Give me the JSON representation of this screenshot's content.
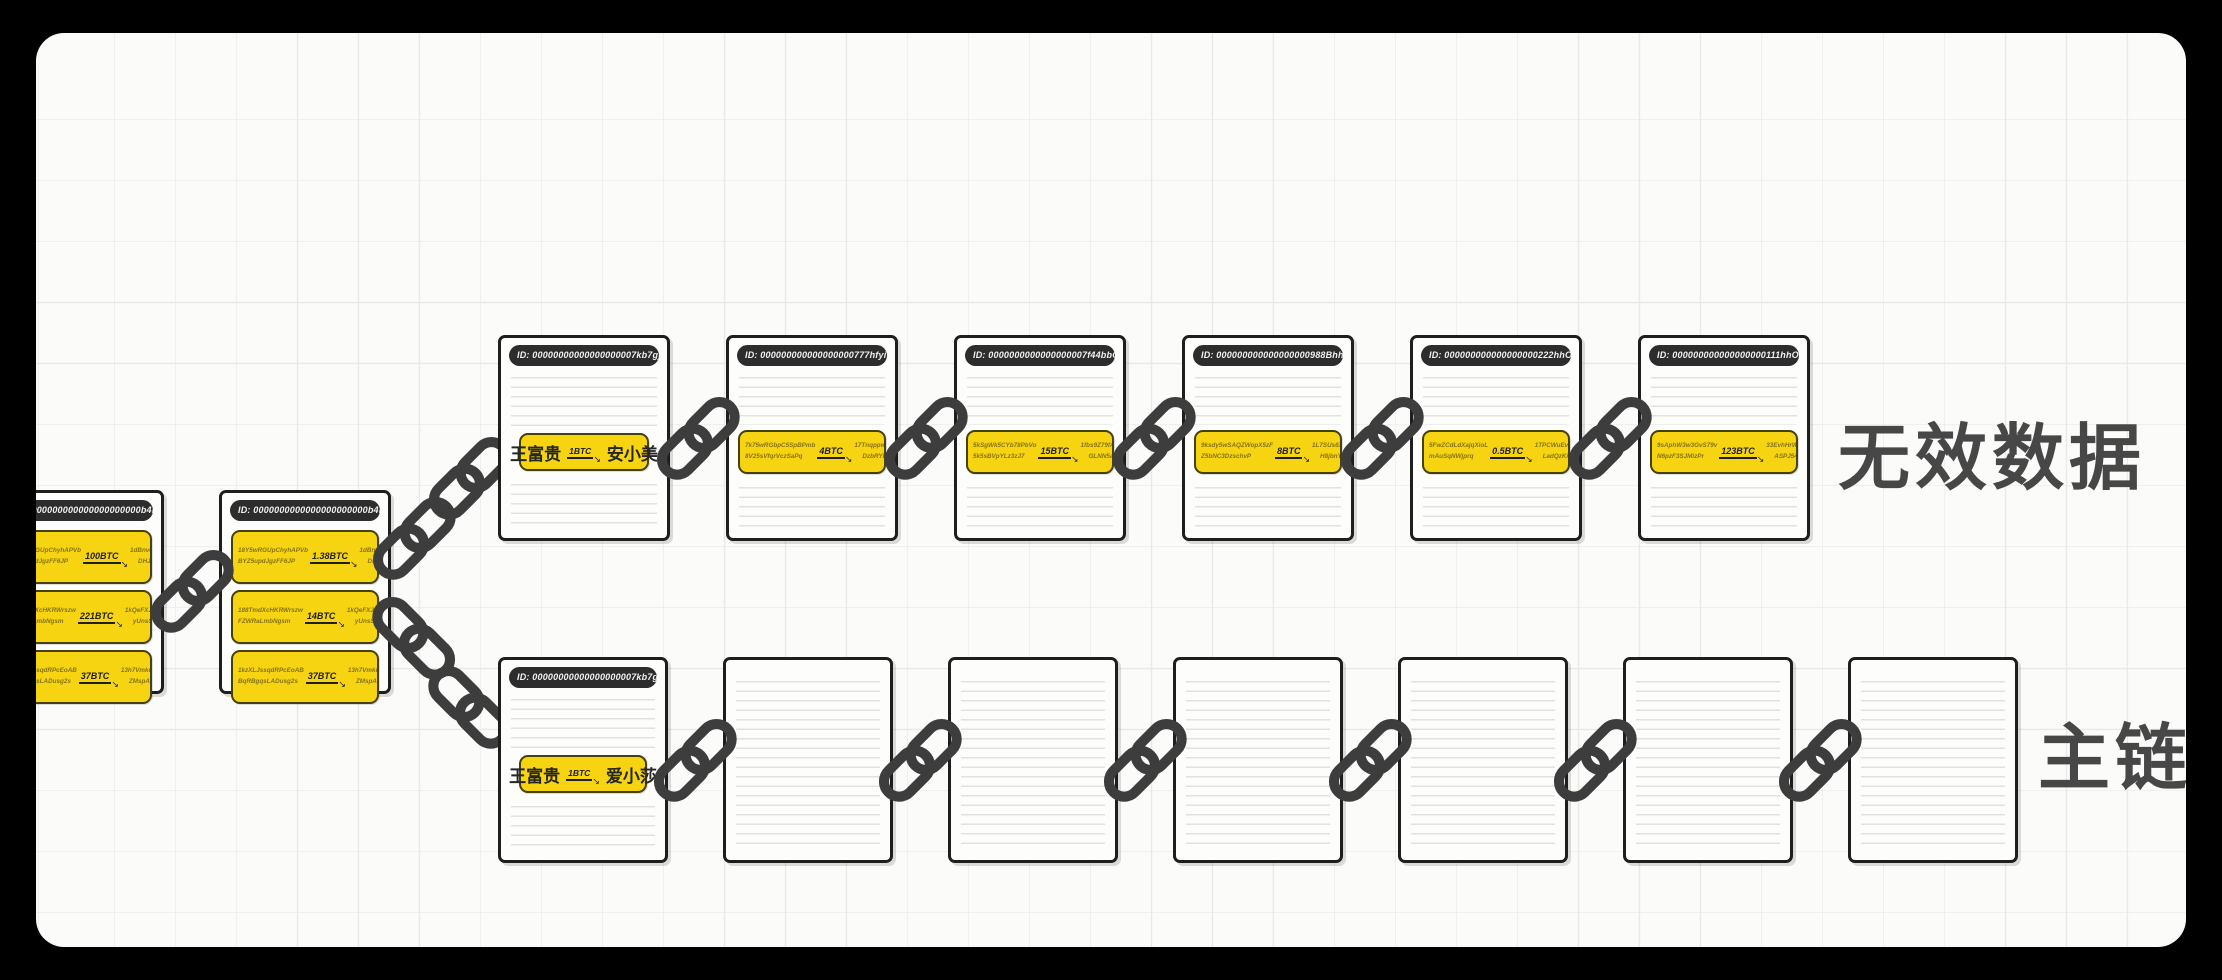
{
  "labels": {
    "invalid_chain": "无效数据",
    "main_chain": "主链"
  },
  "icons": {
    "arrow": "↘",
    "chain_link": "two interlocked stadium links at 45°"
  },
  "colors": {
    "frame": "#000000",
    "canvas": "#fbfbf9",
    "grid_line": "#e9e9e5",
    "paper": "#fdfdfb",
    "block_border": "#1e1e1e",
    "rule_line": "#e1e1dd",
    "id_pill_bg": "#2d2d2d",
    "id_pill_text": "#f2f2f2",
    "tx_bg": "#f6d411",
    "tx_border": "#46400c",
    "tx_addr_text": "#86730f",
    "amount_text": "#1f1f1f",
    "chain_link": "#3d3d3d",
    "label_text": "#474747"
  },
  "parent_blocks": [
    {
      "id": "ID: 0000000000000000000000b4b55b71f8d6ed...",
      "rows": [
        {
          "from1": "18Y5wRGUpChyhAPVb",
          "from2": "BYZ5updJgzFF6JP",
          "amount": "100BTC",
          "to1": "1dBnvdGWDFp7YpPFB",
          "to2": "DHJPDbFDDEd"
        },
        {
          "from1": "188TmdXcHKRWrszw",
          "from2": "FZWRaLmbNgsm",
          "amount": "221BTC",
          "to1": "1kQeFXJrSdKPEYkXySN",
          "to2": "yUnsSJ2VkPQXNq"
        },
        {
          "from1": "1kzXLJssqdRPcEoAB",
          "from2": "BqRBgqsLADusg2s",
          "amount": "37BTC",
          "to1": "13h7VmkuzoM7SH3kkA",
          "to2": "ZMspANmRLBzP"
        }
      ]
    },
    {
      "id": "ID: 0000000000000000000000b4b55b71f8d6ed...",
      "rows": [
        {
          "from1": "18Y5wRGUpChyhAPVb",
          "from2": "BYZ5updJgzFF6JP",
          "amount": "1.38BTC",
          "to1": "1dBnvdGWDFp7YpPFB",
          "to2": "DHJPDbFDDEd"
        },
        {
          "from1": "188TmdXcHKRWrszw",
          "from2": "FZWRaLmbNgsm",
          "amount": "14BTC",
          "to1": "1kQeFXJrSdKPEYkXySN",
          "to2": "yUnsSJ2VkPQXNq"
        },
        {
          "from1": "1kzXLJssqdRPcEoAB",
          "from2": "BqRBgqsLADusg2s",
          "amount": "37BTC",
          "to1": "13h7VmkuzoM7SH3kkA",
          "to2": "ZMspANmRLBzP"
        }
      ]
    }
  ],
  "invalid_blocks": [
    {
      "id": "ID: 00000000000000000007kb7gjK'k1b55ya...",
      "name_row": {
        "from": "王富贵",
        "amount": "1BTC",
        "to": "安小美"
      }
    },
    {
      "id": "ID: 000000000000000000777hfyiTUg1b04Xc...",
      "row": {
        "from1": "7k75wRGbpC5SpBPmb",
        "from2": "8V25sVfqrVczSaPq",
        "amount": "4BTC",
        "to1": "17TnqppwBsdCTnp7YpPQ",
        "to2": "DzbRYE9E9oLXL"
      }
    },
    {
      "id": "ID: 0000000000000000007f44bbO90g1b04Xc...",
      "row": {
        "from1": "5kSgWk5CYb78PbVo",
        "from2": "5k5sBVpYLz3zJ7",
        "amount": "15BTC",
        "to1": "1fbs9Z79fAbLbXS7YpPW",
        "to2": "GLNN5aVKY789T"
      }
    },
    {
      "id": "ID: 000000000000000000988Bhh090g1b04Xc...",
      "row": {
        "from1": "9ksdy5wSAQZWopX5zF",
        "from2": "Z5bNC3DzschvP",
        "amount": "8BTC",
        "to1": "1L7SUs6XwpkkzSgvgR",
        "to2": "H8jbnY9AjkQ8D9"
      }
    },
    {
      "id": "ID: 000000000000000000222hhO90g1b04Xc...",
      "row": {
        "from1": "5FwZCdLdXajqXioL",
        "from2": "mAuSqNWjprq",
        "amount": "0.5BTC",
        "to1": "1TPCWuEvGD9GFY9s7",
        "to2": "LadQzKinnzpEMezgR"
      }
    },
    {
      "id": "ID: 000000000000000000111hhO90g1b04Xc...",
      "row": {
        "from1": "9sAphW3w3GvS79v",
        "from2": "N6pzF3SJMizPr",
        "amount": "123BTC",
        "to1": "33EvhHrWLKn75SRGpe",
        "to2": "ASPJ54gzLHdSAJ9V"
      }
    }
  ],
  "main_blocks": [
    {
      "id": "ID: 00000000000000000007kb7gjK'k1b55ya...",
      "name_row": {
        "from": "王富贵",
        "amount": "1BTC",
        "to": "爱小莎"
      }
    }
  ]
}
